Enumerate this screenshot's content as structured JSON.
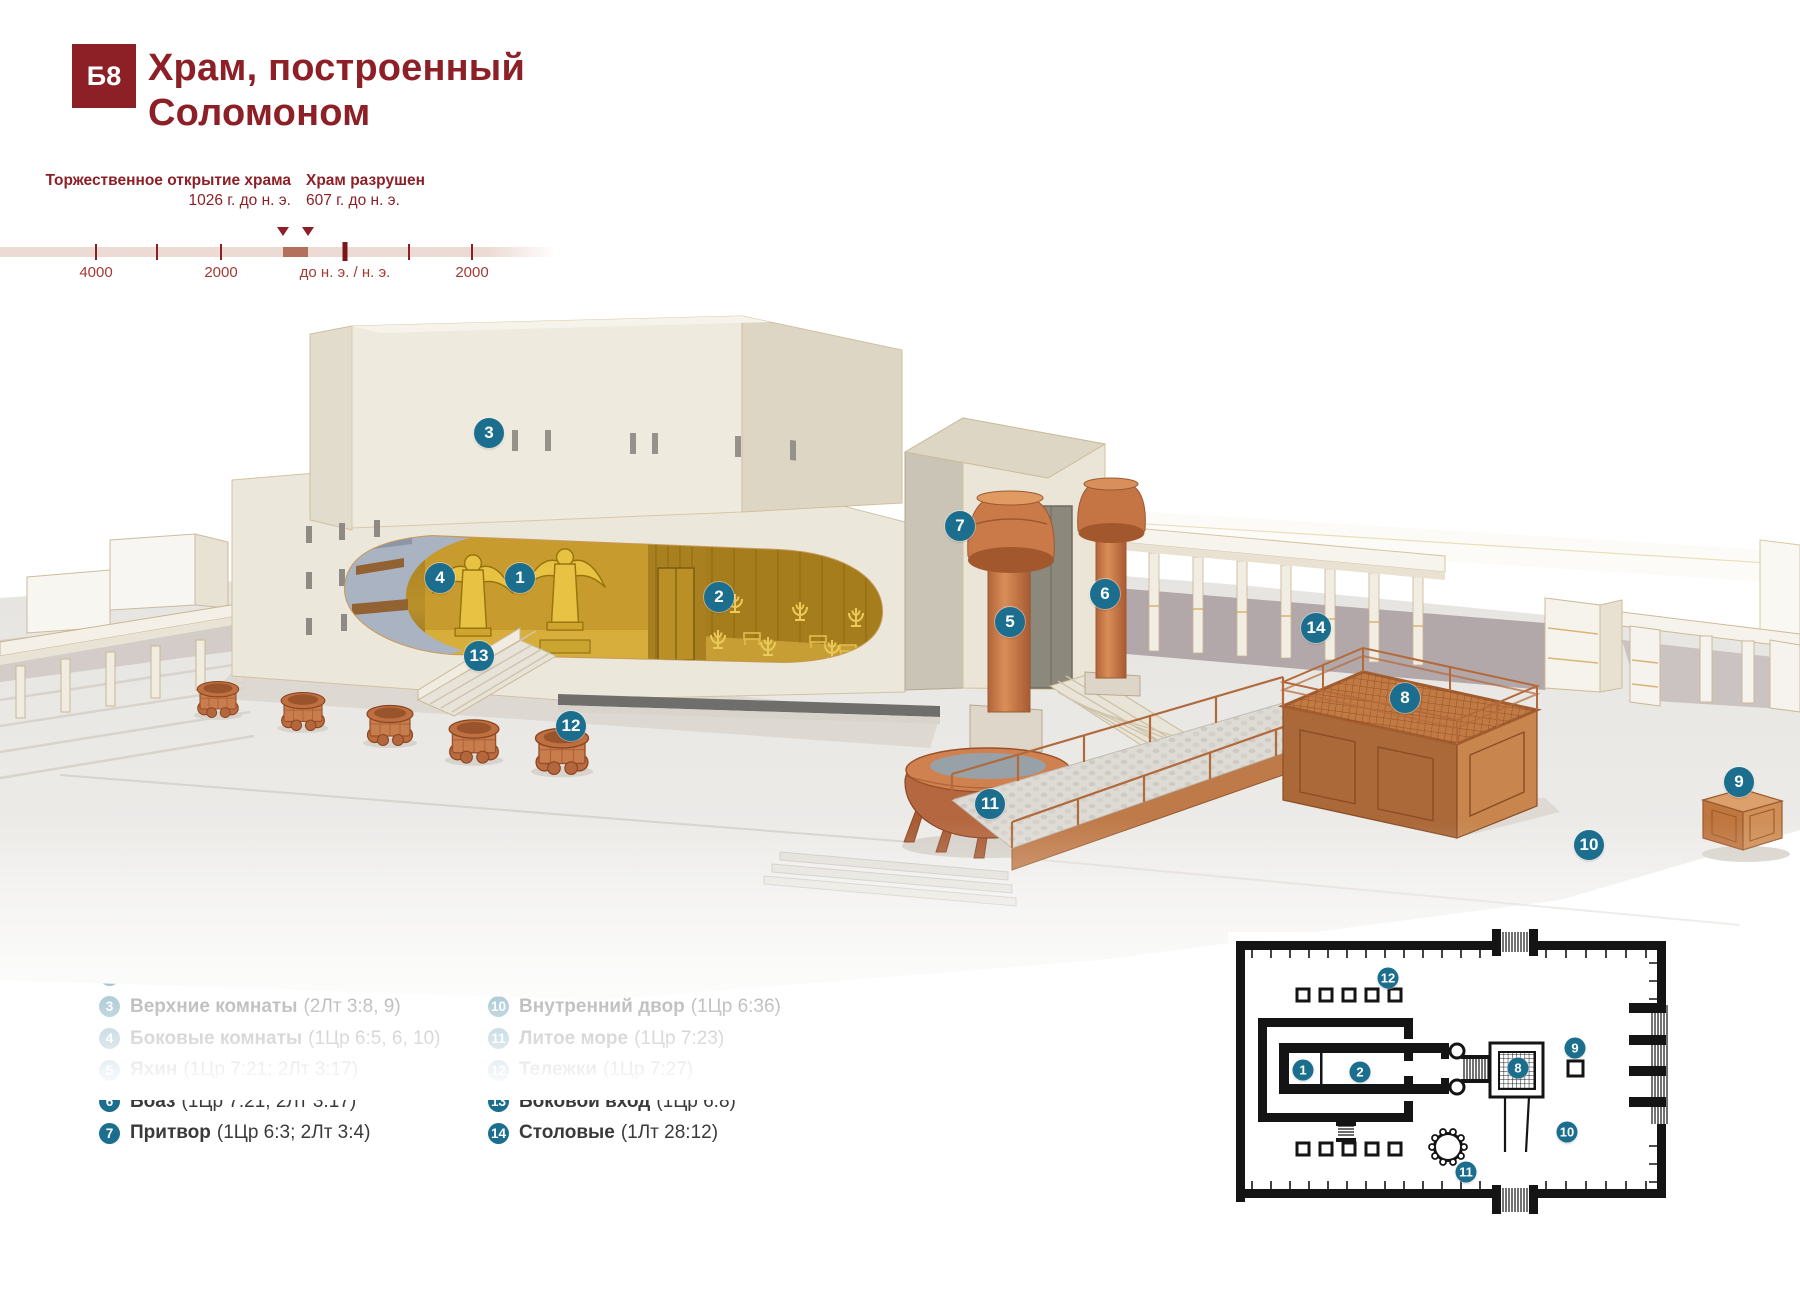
{
  "header": {
    "badge": "Б8",
    "title_line1": "Храм, построенный",
    "title_line2": "Соломоном"
  },
  "timeline": {
    "events": [
      {
        "name": "Торжественное открытие храма",
        "date": "1026 г. до н. э.",
        "x": 283,
        "align": "right"
      },
      {
        "name": "Храм разрушен",
        "date": "607 г. до н. э.",
        "x": 308,
        "align": "left"
      }
    ],
    "ticks": [
      {
        "x": 96,
        "label": "4000",
        "major": false
      },
      {
        "x": 157,
        "label": "",
        "major": false
      },
      {
        "x": 221,
        "label": "2000",
        "major": false
      },
      {
        "x": 345,
        "label": "до н. э. / н. э.",
        "major": true
      },
      {
        "x": 409,
        "label": "",
        "major": false
      },
      {
        "x": 472,
        "label": "2000",
        "major": false
      }
    ],
    "bar": {
      "highlight_from": 283,
      "highlight_to": 308
    }
  },
  "legend": {
    "title": "Храм и внутренний двор",
    "columns": [
      {
        "items": [
          {
            "n": "1",
            "name": "Святое святых",
            "ref": "(1Цр 6:16, 20)"
          },
          {
            "n": "2",
            "name": "Святое",
            "ref": "(2Лт 5:9)"
          },
          {
            "n": "3",
            "name": "Верхние комнаты",
            "ref": "(2Лт 3:8, 9)"
          },
          {
            "n": "4",
            "name": "Боковые комнаты",
            "ref": "(1Цр 6:5, 6, 10)"
          },
          {
            "n": "5",
            "name": "Яхин",
            "ref": "(1Цр 7:21; 2Лт 3:17)"
          },
          {
            "n": "6",
            "name": "Боаз",
            "ref": "(1Цр 7:21; 2Лт 3:17)"
          },
          {
            "n": "7",
            "name": "Притвор",
            "ref": "(1Цр 6:3; 2Лт 3:4)"
          }
        ]
      },
      {
        "items": [
          {
            "n": "8",
            "name": "Медный жертвенник",
            "ref": "(2Лт 4:1)"
          },
          {
            "n": "9",
            "name": "Медный помост",
            "ref": "(2Лт 6:13)"
          },
          {
            "n": "10",
            "name": "Внутренний двор",
            "ref": "(1Цр 6:36)"
          },
          {
            "n": "11",
            "name": "Литое море",
            "ref": "(1Цр 7:23)"
          },
          {
            "n": "12",
            "name": "Тележки",
            "ref": "(1Цр 7:27)"
          },
          {
            "n": "13",
            "name": "Боковой вход",
            "ref": "(1Цр 6:8)"
          },
          {
            "n": "14",
            "name": "Столовые",
            "ref": "(1Лт 28:12)"
          }
        ]
      }
    ]
  },
  "markers": {
    "illustration": [
      {
        "n": "1",
        "x": 520,
        "y": 578
      },
      {
        "n": "2",
        "x": 719,
        "y": 597
      },
      {
        "n": "3",
        "x": 489,
        "y": 433
      },
      {
        "n": "4",
        "x": 440,
        "y": 578
      },
      {
        "n": "5",
        "x": 1010,
        "y": 622
      },
      {
        "n": "6",
        "x": 1105,
        "y": 594
      },
      {
        "n": "7",
        "x": 960,
        "y": 526
      },
      {
        "n": "8",
        "x": 1405,
        "y": 698
      },
      {
        "n": "9",
        "x": 1739,
        "y": 782
      },
      {
        "n": "10",
        "x": 1589,
        "y": 845
      },
      {
        "n": "11",
        "x": 990,
        "y": 804
      },
      {
        "n": "12",
        "x": 571,
        "y": 726
      },
      {
        "n": "13",
        "x": 479,
        "y": 656
      },
      {
        "n": "14",
        "x": 1316,
        "y": 628
      }
    ],
    "plan": [
      {
        "n": "12",
        "x": 1388,
        "y": 978
      },
      {
        "n": "1",
        "x": 1303,
        "y": 1070
      },
      {
        "n": "2",
        "x": 1360,
        "y": 1072
      },
      {
        "n": "8",
        "x": 1518,
        "y": 1068
      },
      {
        "n": "9",
        "x": 1575,
        "y": 1048
      },
      {
        "n": "10",
        "x": 1567,
        "y": 1132
      },
      {
        "n": "11",
        "x": 1466,
        "y": 1172
      }
    ]
  },
  "colors": {
    "accent_maroon": "#8d2026",
    "badge_teal": "#1b6e8e",
    "timeline_bar": "#ecdbd4",
    "timeline_highlight": "#b3705c"
  }
}
